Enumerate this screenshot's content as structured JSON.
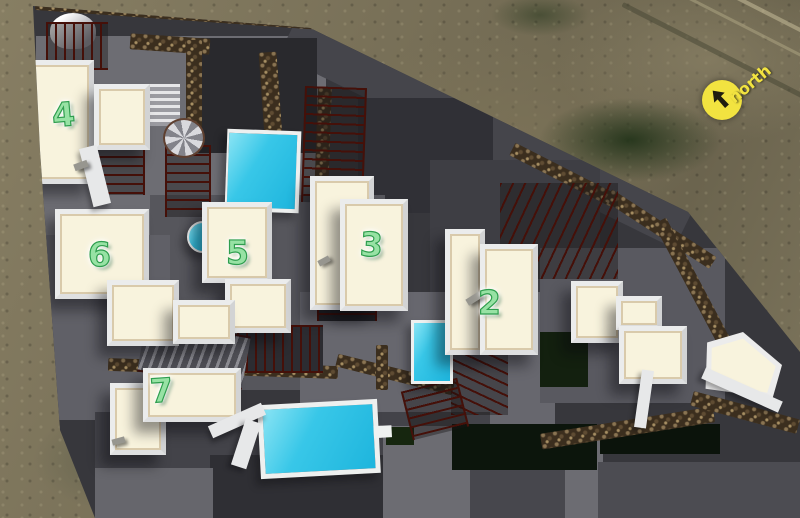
{
  "site_plan": {
    "north_label": "north",
    "units": {
      "u2": {
        "number": "2"
      },
      "u3": {
        "number": "3"
      },
      "u4": {
        "number": "4"
      },
      "u5": {
        "number": "5"
      },
      "u6": {
        "number": "6"
      },
      "u7": {
        "number": "7"
      }
    },
    "colors": {
      "unit_number_green": "#97e2a4",
      "pool_cyan": "#35c6e8",
      "roof_cream": "#f8f3dd",
      "site_ground_gray": "#37373c",
      "pergola_brown": "#451009",
      "stone_wall_brown": "#5f4c33",
      "north_yellow": "#f2e340"
    }
  }
}
